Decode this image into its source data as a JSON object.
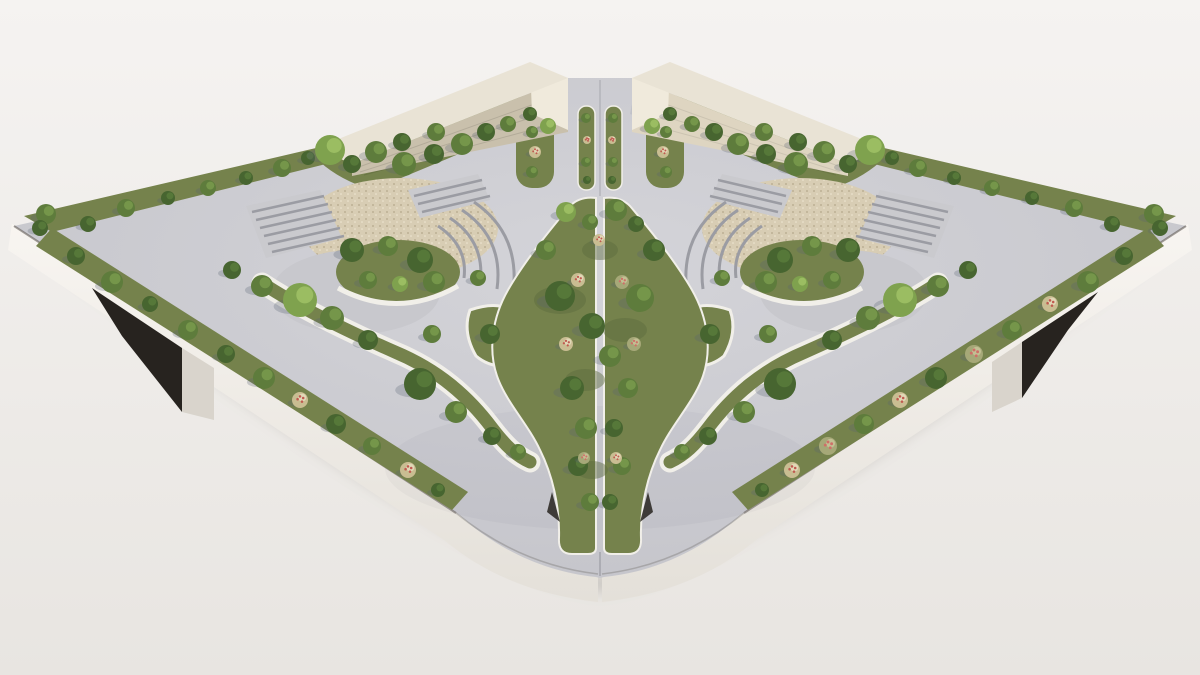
{
  "canvas": {
    "width": 1200,
    "height": 675
  },
  "palette": {
    "bg_top": "#f5f3f1",
    "bg_bottom": "#e8e5e1",
    "ground_shadow": "#8f8a82",
    "side_top": "#f8f5f1",
    "side_bottom": "#e4e0d9",
    "seam": "#57514a",
    "opening_dark": "#27231f",
    "ramp_face": "#d9d4cc",
    "paving_light": "#d4d4d9",
    "paving": "#c3c3c9",
    "paving_flat": "#c8c8cd",
    "step_base": "#cacace",
    "step_line": "#9b9ca3",
    "rim_white": "#f1efe9",
    "bed_base": "#75824c",
    "bed_dark": "#5b6a3e",
    "bed_light": "#8c9c5c",
    "gravel_base": "#d8cdb4",
    "gravel_dark": "#b4a78a",
    "gravel_light": "#efe7d3",
    "wall_top": "#e9e3d5",
    "wall_face_left": "#c9c0ac",
    "wall_face_right": "#ded5c1",
    "wall_end": "#f0eadc",
    "shadow": "#5a6472",
    "veg": {
      "d": {
        "base": "#476530",
        "hi": "#5a7d3c"
      },
      "m": {
        "base": "#5e7c3c",
        "hi": "#7a9c4e"
      },
      "l": {
        "base": "#7fa24e",
        "hi": "#a3c468"
      },
      "f": {
        "base": "#c9bd92",
        "hi": "#e7dfc0",
        "dot": "#c05a50"
      },
      "p": {
        "base": "#a6a878",
        "hi": "#c9c69a",
        "dot": "#cf6f68"
      }
    }
  },
  "vegetation": {
    "border_upper_left": [
      [
        46,
        214,
        10,
        "m"
      ],
      [
        88,
        224,
        8,
        "d"
      ],
      [
        126,
        208,
        9,
        "m"
      ],
      [
        168,
        198,
        7,
        "d"
      ],
      [
        208,
        188,
        8,
        "m"
      ],
      [
        246,
        178,
        7,
        "d"
      ],
      [
        282,
        168,
        9,
        "m"
      ],
      [
        308,
        158,
        7,
        "d"
      ],
      [
        40,
        228,
        8,
        "d"
      ]
    ],
    "bed_wall_left": [
      [
        330,
        150,
        15,
        "l"
      ],
      [
        352,
        164,
        9,
        "d"
      ],
      [
        376,
        152,
        11,
        "m"
      ],
      [
        402,
        142,
        9,
        "d"
      ],
      [
        404,
        164,
        12,
        "m"
      ],
      [
        434,
        154,
        10,
        "d"
      ],
      [
        436,
        132,
        9,
        "m"
      ],
      [
        462,
        144,
        11,
        "m"
      ],
      [
        486,
        132,
        9,
        "d"
      ],
      [
        508,
        124,
        8,
        "m"
      ],
      [
        530,
        114,
        7,
        "d"
      ],
      [
        548,
        126,
        8,
        "l"
      ]
    ],
    "entrance_beds": [
      [
        532,
        132,
        6,
        "m"
      ],
      [
        535,
        152,
        6,
        "f"
      ],
      [
        532,
        172,
        6,
        "m"
      ],
      [
        666,
        132,
        6,
        "m"
      ],
      [
        663,
        152,
        6,
        "f"
      ],
      [
        666,
        172,
        6,
        "m"
      ]
    ],
    "gap_medians": [
      [
        586,
        118,
        5,
        "m"
      ],
      [
        587,
        140,
        4,
        "f"
      ],
      [
        586,
        162,
        5,
        "m"
      ],
      [
        587,
        180,
        4,
        "d"
      ],
      [
        613,
        118,
        5,
        "m"
      ],
      [
        612,
        140,
        4,
        "f"
      ],
      [
        613,
        162,
        5,
        "m"
      ],
      [
        612,
        180,
        4,
        "d"
      ]
    ],
    "border_upper_right": [
      [
        1154,
        214,
        10,
        "m"
      ],
      [
        1112,
        224,
        8,
        "d"
      ],
      [
        1074,
        208,
        9,
        "m"
      ],
      [
        1032,
        198,
        7,
        "d"
      ],
      [
        992,
        188,
        8,
        "m"
      ],
      [
        954,
        178,
        7,
        "d"
      ],
      [
        918,
        168,
        9,
        "m"
      ],
      [
        892,
        158,
        7,
        "d"
      ],
      [
        1160,
        228,
        8,
        "d"
      ]
    ],
    "bed_wall_right": [
      [
        870,
        150,
        15,
        "l"
      ],
      [
        848,
        164,
        9,
        "d"
      ],
      [
        824,
        152,
        11,
        "m"
      ],
      [
        798,
        142,
        9,
        "d"
      ],
      [
        796,
        164,
        12,
        "m"
      ],
      [
        766,
        154,
        10,
        "d"
      ],
      [
        764,
        132,
        9,
        "m"
      ],
      [
        738,
        144,
        11,
        "m"
      ],
      [
        714,
        132,
        9,
        "d"
      ],
      [
        692,
        124,
        8,
        "m"
      ],
      [
        670,
        114,
        7,
        "d"
      ],
      [
        652,
        126,
        8,
        "l"
      ]
    ],
    "border_lower_left": [
      [
        76,
        256,
        9,
        "d"
      ],
      [
        112,
        282,
        11,
        "m"
      ],
      [
        150,
        304,
        8,
        "d"
      ],
      [
        188,
        330,
        10,
        "m"
      ],
      [
        226,
        354,
        9,
        "d"
      ],
      [
        264,
        378,
        11,
        "m"
      ],
      [
        300,
        400,
        8,
        "f"
      ],
      [
        336,
        424,
        10,
        "d"
      ],
      [
        372,
        446,
        9,
        "m"
      ],
      [
        408,
        470,
        8,
        "f"
      ],
      [
        438,
        490,
        7,
        "d"
      ]
    ],
    "border_lower_right": [
      [
        1124,
        256,
        9,
        "d"
      ],
      [
        1088,
        282,
        11,
        "m"
      ],
      [
        1050,
        304,
        8,
        "f"
      ],
      [
        1012,
        330,
        10,
        "m"
      ],
      [
        974,
        354,
        9,
        "p"
      ],
      [
        936,
        378,
        11,
        "d"
      ],
      [
        900,
        400,
        8,
        "f"
      ],
      [
        864,
        424,
        10,
        "m"
      ],
      [
        828,
        446,
        9,
        "p"
      ],
      [
        792,
        470,
        8,
        "f"
      ],
      [
        762,
        490,
        7,
        "d"
      ]
    ],
    "complex_left": [
      [
        352,
        250,
        12,
        "d"
      ],
      [
        388,
        246,
        10,
        "m"
      ],
      [
        420,
        260,
        13,
        "d"
      ],
      [
        368,
        280,
        9,
        "m"
      ],
      [
        400,
        284,
        8,
        "l"
      ],
      [
        434,
        282,
        11,
        "m"
      ],
      [
        300,
        300,
        17,
        "l"
      ],
      [
        262,
        286,
        11,
        "m"
      ],
      [
        232,
        270,
        9,
        "d"
      ],
      [
        332,
        318,
        12,
        "m"
      ],
      [
        368,
        340,
        10,
        "d"
      ],
      [
        432,
        334,
        9,
        "m"
      ],
      [
        490,
        334,
        10,
        "d"
      ],
      [
        478,
        278,
        8,
        "m"
      ]
    ],
    "complex_right": [
      [
        848,
        250,
        12,
        "d"
      ],
      [
        812,
        246,
        10,
        "m"
      ],
      [
        780,
        260,
        13,
        "d"
      ],
      [
        832,
        280,
        9,
        "m"
      ],
      [
        800,
        284,
        8,
        "l"
      ],
      [
        766,
        282,
        11,
        "m"
      ],
      [
        900,
        300,
        17,
        "l"
      ],
      [
        938,
        286,
        11,
        "m"
      ],
      [
        968,
        270,
        9,
        "d"
      ],
      [
        868,
        318,
        12,
        "m"
      ],
      [
        832,
        340,
        10,
        "d"
      ],
      [
        768,
        334,
        9,
        "m"
      ],
      [
        710,
        334,
        10,
        "d"
      ],
      [
        722,
        278,
        8,
        "m"
      ]
    ],
    "band_left": [
      [
        420,
        384,
        16,
        "d"
      ],
      [
        456,
        412,
        11,
        "m"
      ],
      [
        492,
        436,
        9,
        "d"
      ],
      [
        518,
        452,
        8,
        "m"
      ]
    ],
    "band_right": [
      [
        780,
        384,
        16,
        "d"
      ],
      [
        744,
        412,
        11,
        "m"
      ],
      [
        708,
        436,
        9,
        "d"
      ],
      [
        682,
        452,
        8,
        "m"
      ]
    ],
    "central_spine": [
      [
        566,
        212,
        10,
        "l"
      ],
      [
        590,
        222,
        8,
        "m"
      ],
      [
        616,
        210,
        11,
        "m"
      ],
      [
        636,
        224,
        8,
        "d"
      ],
      [
        546,
        250,
        10,
        "m"
      ],
      [
        654,
        250,
        11,
        "d"
      ],
      [
        560,
        296,
        15,
        "d"
      ],
      [
        640,
        298,
        14,
        "m"
      ],
      [
        592,
        326,
        13,
        "d"
      ],
      [
        610,
        356,
        11,
        "m"
      ],
      [
        572,
        388,
        12,
        "d"
      ],
      [
        628,
        388,
        10,
        "m"
      ],
      [
        586,
        428,
        11,
        "m"
      ],
      [
        614,
        428,
        9,
        "d"
      ],
      [
        578,
        466,
        10,
        "d"
      ],
      [
        622,
        466,
        9,
        "m"
      ],
      [
        590,
        502,
        9,
        "m"
      ],
      [
        610,
        502,
        8,
        "d"
      ],
      [
        578,
        280,
        7,
        "f"
      ],
      [
        622,
        282,
        7,
        "p"
      ],
      [
        566,
        344,
        7,
        "f"
      ],
      [
        634,
        344,
        7,
        "p"
      ],
      [
        584,
        458,
        6,
        "p"
      ],
      [
        616,
        458,
        6,
        "f"
      ],
      [
        599,
        240,
        6,
        "f"
      ]
    ]
  }
}
